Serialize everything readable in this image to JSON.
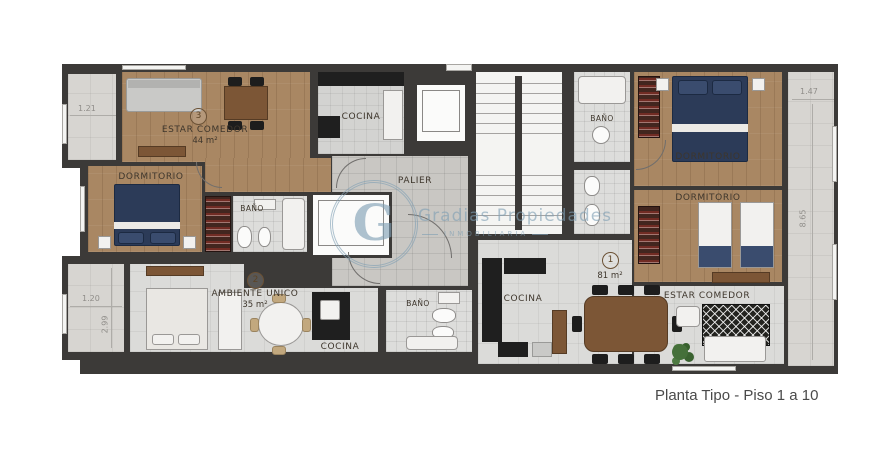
{
  "title": "Planta Tipo - Piso 1 a 10",
  "watermark": {
    "letter": "G",
    "name": "Gradias Propiedades",
    "tagline": "INMOBILIARIA"
  },
  "units": {
    "u1": {
      "number": "1",
      "area": "81 m²"
    },
    "u2": {
      "number": "2",
      "area": "35 m²"
    },
    "u3": {
      "number": "3",
      "area": "44 m²"
    }
  },
  "rooms": {
    "estar_u3": "ESTAR COMEDOR",
    "dorm_u3": "DORMITORIO",
    "bano_u3": "BAÑO",
    "cocina_u3": "COCINA",
    "palier": "PALIER",
    "bano_u1": "BAÑO",
    "dorm_u1_a": "DORMITORIO",
    "dorm_u1_b": "DORMITORIO",
    "cocina_u1": "COCINA",
    "estar_u1": "ESTAR COMEDOR",
    "ambiente_u2": "AMBIENTE UNICO",
    "cocina_u2": "COCINA",
    "bano_u2": "BAÑO"
  },
  "dimensions": {
    "top_left_width": "1.21",
    "bottom_left_width": "1.20",
    "bottom_left_depth": "2.99",
    "right_width": "1.47",
    "right_depth": "8.65"
  },
  "colors": {
    "wall": "#3c3a38",
    "wood_floor": "#a98763",
    "tile_floor": "#c9c7c3",
    "bed_navy": "#2c3b58",
    "watermark_blue": "#7f9fb4",
    "caption_text": "#4a4a4a"
  }
}
